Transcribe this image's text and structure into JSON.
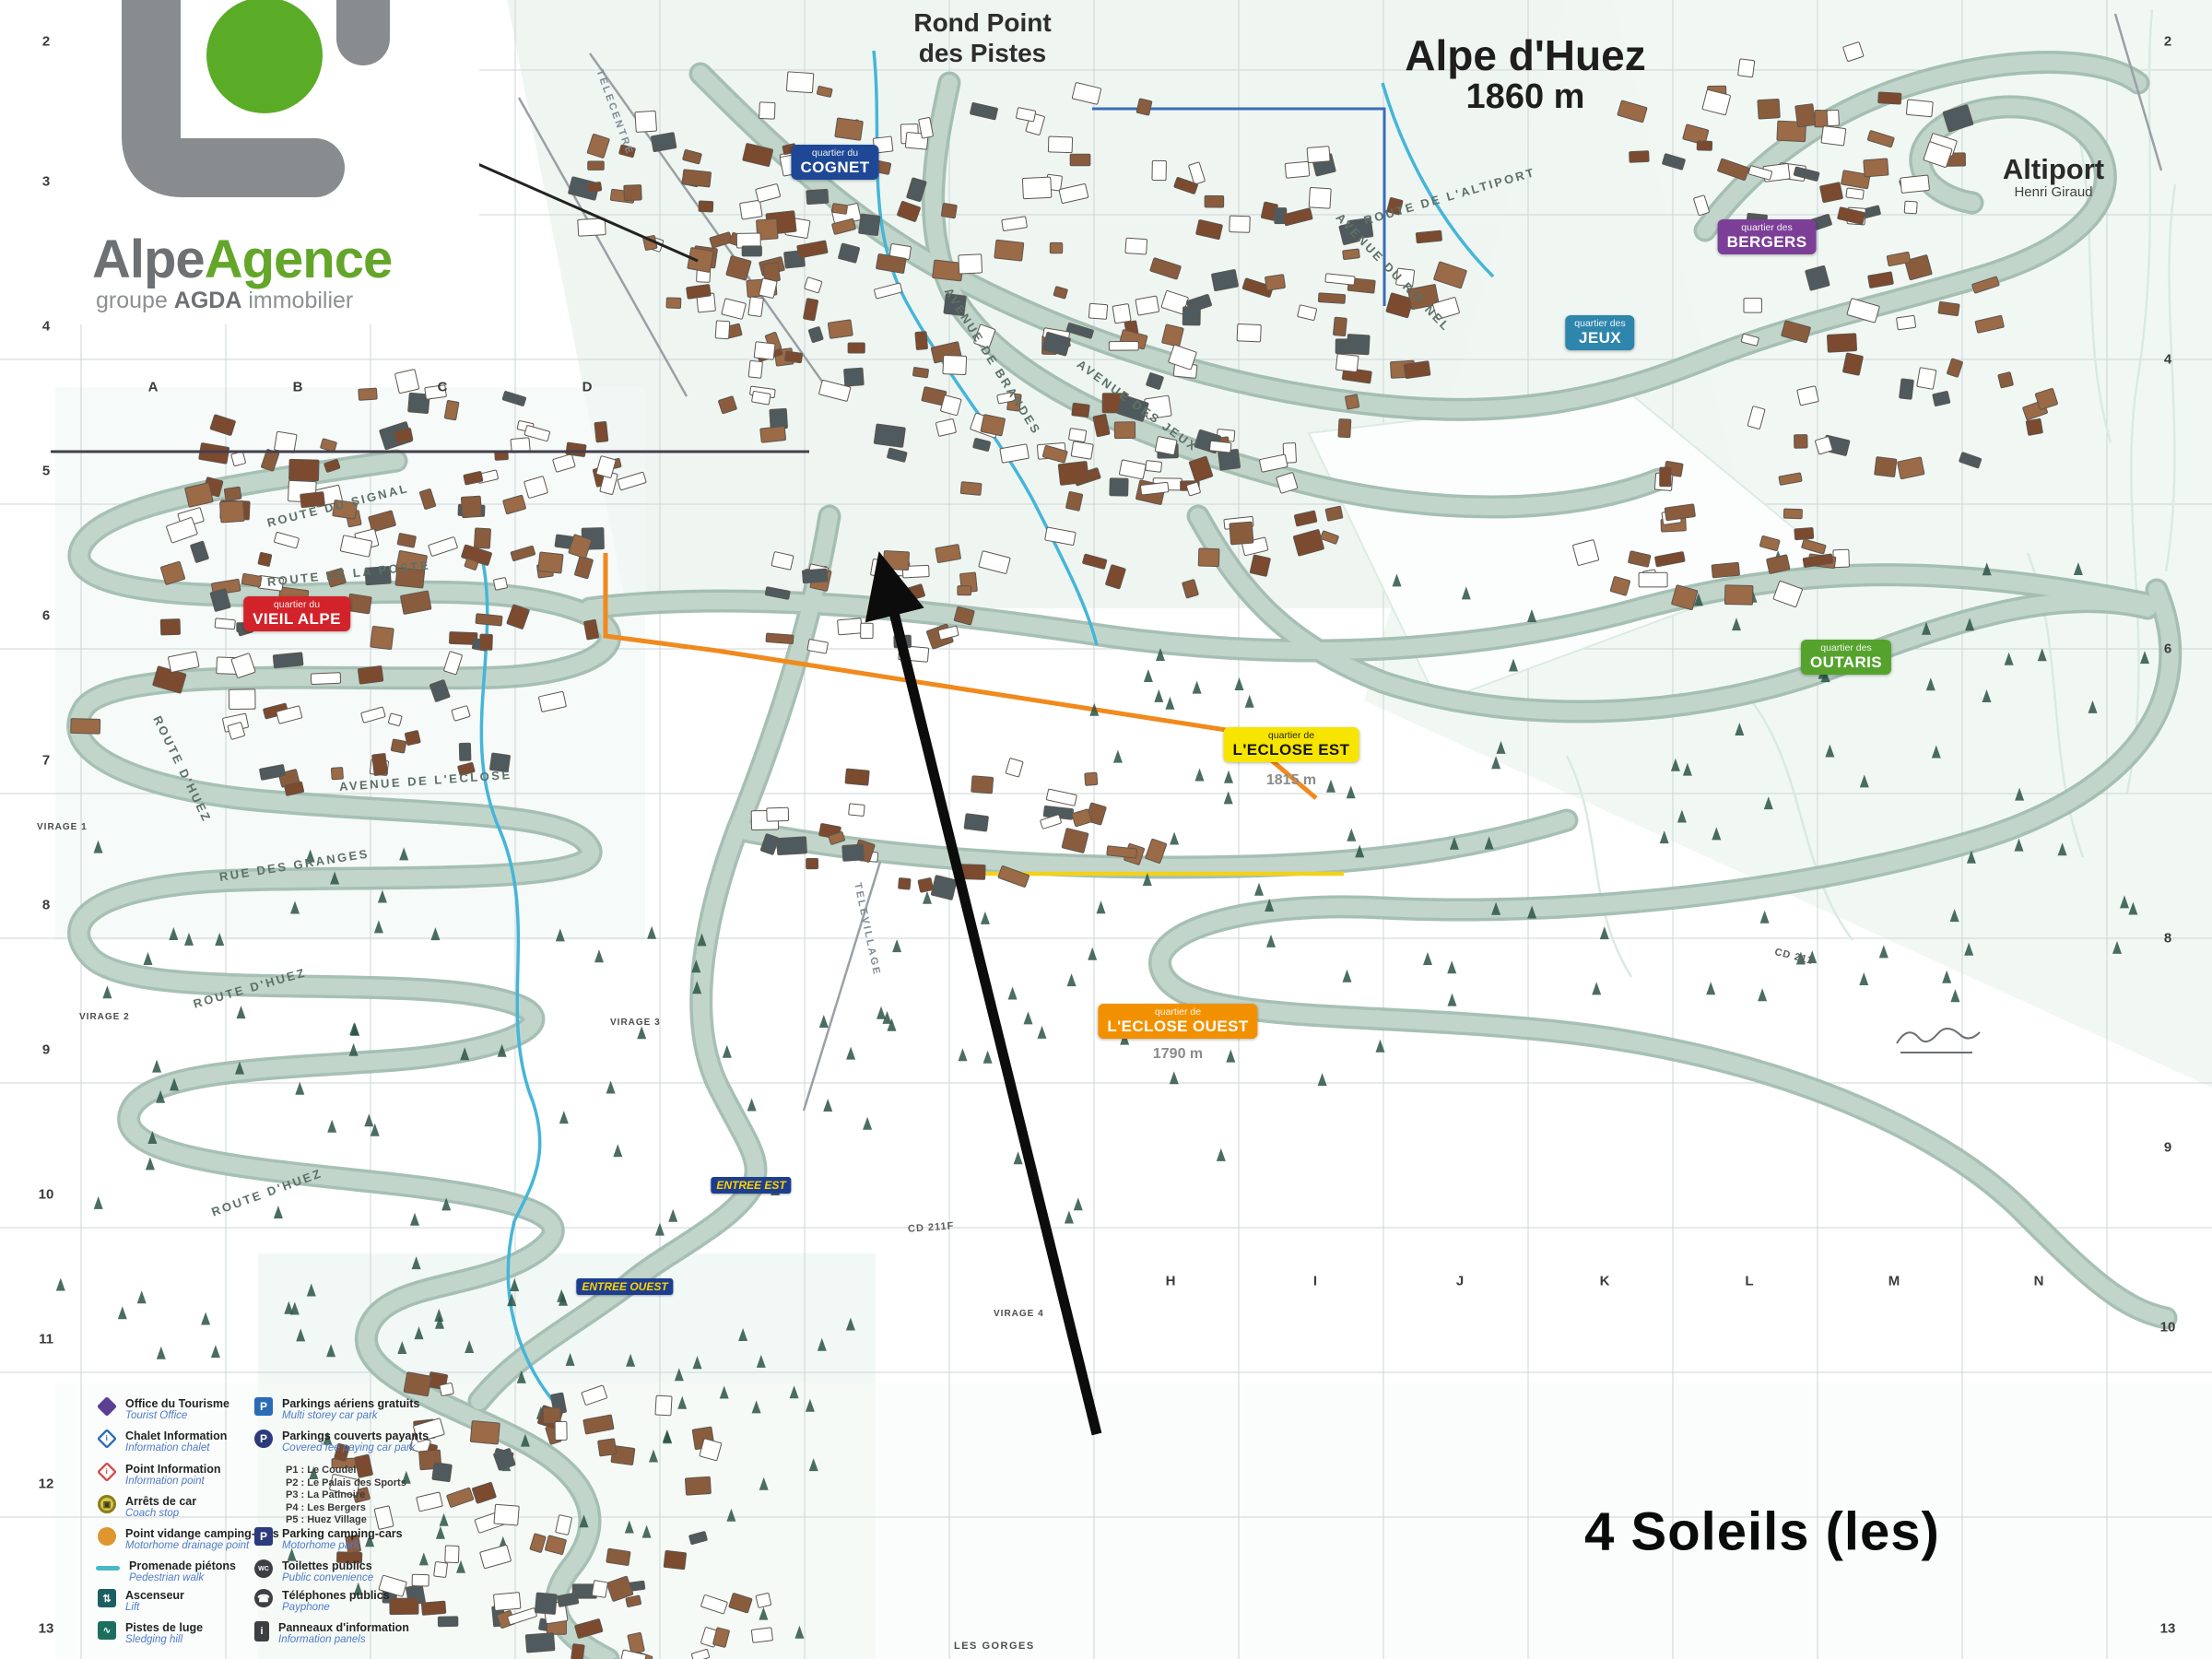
{
  "logo": {
    "brand_gray": "Alpe",
    "brand_green": "Agence",
    "subtitle_prefix": "groupe ",
    "subtitle_bold": "AGDA",
    "subtitle_suffix": " immobilier"
  },
  "title": {
    "resort": "Alpe d'Huez",
    "altitude": "1860 m"
  },
  "landmarks": {
    "rond_point_line1": "Rond Point",
    "rond_point_line2": "des Pistes",
    "altiport": "Altiport",
    "altiport_sub": "Henri Giraud",
    "les_gorges": "LES GORGES"
  },
  "annotation": {
    "property_name": "4 Soleils (les)"
  },
  "quartiers": [
    {
      "prefix": "quartier du",
      "name": "COGNET",
      "color": "#1e4896"
    },
    {
      "prefix": "quartier des",
      "name": "BERGERS",
      "color": "#7c3f97"
    },
    {
      "prefix": "quartier des",
      "name": "JEUX",
      "color": "#2f86ad"
    },
    {
      "prefix": "quartier du",
      "name": "VIEIL ALPE",
      "color": "#d3232a"
    },
    {
      "prefix": "quartier de",
      "name": "L'ECLOSE EST",
      "color": "#f7e500",
      "altitude": "1815 m"
    },
    {
      "prefix": "quartier de",
      "name": "L'ECLOSE OUEST",
      "color": "#f29100",
      "altitude": "1790 m"
    },
    {
      "prefix": "quartier des",
      "name": "OUTARIS",
      "color": "#55a32c"
    }
  ],
  "entrances": [
    {
      "label": "ENTREE EST"
    },
    {
      "label": "ENTREE OUEST"
    }
  ],
  "streets": [
    {
      "label": "ROUTE DU SIGNAL"
    },
    {
      "label": "ROUTE DE LA POSTE"
    },
    {
      "label": "AVENUE DE L'ECLOSE"
    },
    {
      "label": "RUE DES GRANGES"
    },
    {
      "label": "ROUTE D'HUEZ"
    },
    {
      "label": "ROUTE D'HUEZ"
    },
    {
      "label": "ROUTE D'HUEZ"
    },
    {
      "label": "TELECENTRE"
    },
    {
      "label": "TELEVILLAGE"
    },
    {
      "label": "AVENUE DES JEUX"
    },
    {
      "label": "AVENUE DE BRANDES"
    },
    {
      "label": "AVENUE DU RIF NEL"
    },
    {
      "label": "ROUTE DE L'ALTIPORT"
    }
  ],
  "roads_cd": [
    {
      "label": "CD 211F"
    },
    {
      "label": "CD 211"
    }
  ],
  "virages": [
    {
      "label": "VIRAGE 1"
    },
    {
      "label": "VIRAGE 2"
    },
    {
      "label": "VIRAGE 3"
    },
    {
      "label": "VIRAGE 4"
    }
  ],
  "grid": {
    "letters_top": [
      "A",
      "B",
      "C",
      "D"
    ],
    "letters_bottom": [
      "H",
      "I",
      "J",
      "K",
      "L",
      "M",
      "N"
    ],
    "numbers_left": [
      "2",
      "3",
      "4",
      "5",
      "6",
      "7",
      "8",
      "9",
      "10",
      "11",
      "12",
      "13"
    ],
    "numbers_right": [
      "2",
      "4",
      "6",
      "8",
      "9",
      "10",
      "13"
    ]
  },
  "legend": {
    "left": [
      {
        "icon": "tourist-office-icon",
        "fr": "Office du Tourisme",
        "en": "Tourist Office"
      },
      {
        "icon": "chalet-information-icon",
        "fr": "Chalet Information",
        "en": "Information chalet"
      },
      {
        "icon": "point-information-icon",
        "fr": "Point Information",
        "en": "Information point"
      },
      {
        "icon": "coach-stop-icon",
        "fr": "Arrêts de car",
        "en": "Coach stop"
      },
      {
        "icon": "motorhome-drainage-icon",
        "fr": "Point vidange camping-cars",
        "en": "Motorhome drainage point"
      },
      {
        "icon": "pedestrian-walk-icon",
        "fr": "Promenade piétons",
        "en": "Pedestrian walk"
      },
      {
        "icon": "lift-icon",
        "fr": "Ascenseur",
        "en": "Lift"
      },
      {
        "icon": "sledging-icon",
        "fr": "Pistes de luge",
        "en": "Sledging hill"
      }
    ],
    "right": [
      {
        "icon": "open-parking-icon",
        "fr": "Parkings aériens gratuits",
        "en": "Multi storey car park"
      },
      {
        "icon": "covered-parking-icon",
        "fr": "Parkings couverts payants",
        "en": "Covered fee paying car park"
      },
      {
        "icon": "motorhome-parking-icon",
        "fr": "Parking camping-cars",
        "en": "Motorhome park"
      },
      {
        "icon": "toilets-icon",
        "fr": "Toilettes publics",
        "en": "Public convenience"
      },
      {
        "icon": "payphone-icon",
        "fr": "Téléphones publics",
        "en": "Payphone"
      },
      {
        "icon": "information-panels-icon",
        "fr": "Panneaux d'information",
        "en": "Information panels"
      }
    ],
    "parkings": [
      "P1 : Le Coudel",
      "P2 : Le Palais des Sports",
      "P3 : La Patinoire",
      "P4 : Les Bergers",
      "P5 : Huez Village"
    ]
  },
  "colors": {
    "road": "#bdd2c8",
    "river": "#45b5d9",
    "route_orange": "#f08a1d",
    "route_yellow": "#f3d11d",
    "arrow": "#0c0c0c",
    "logo_green": "#5aac27",
    "logo_gray": "#898c8e"
  }
}
